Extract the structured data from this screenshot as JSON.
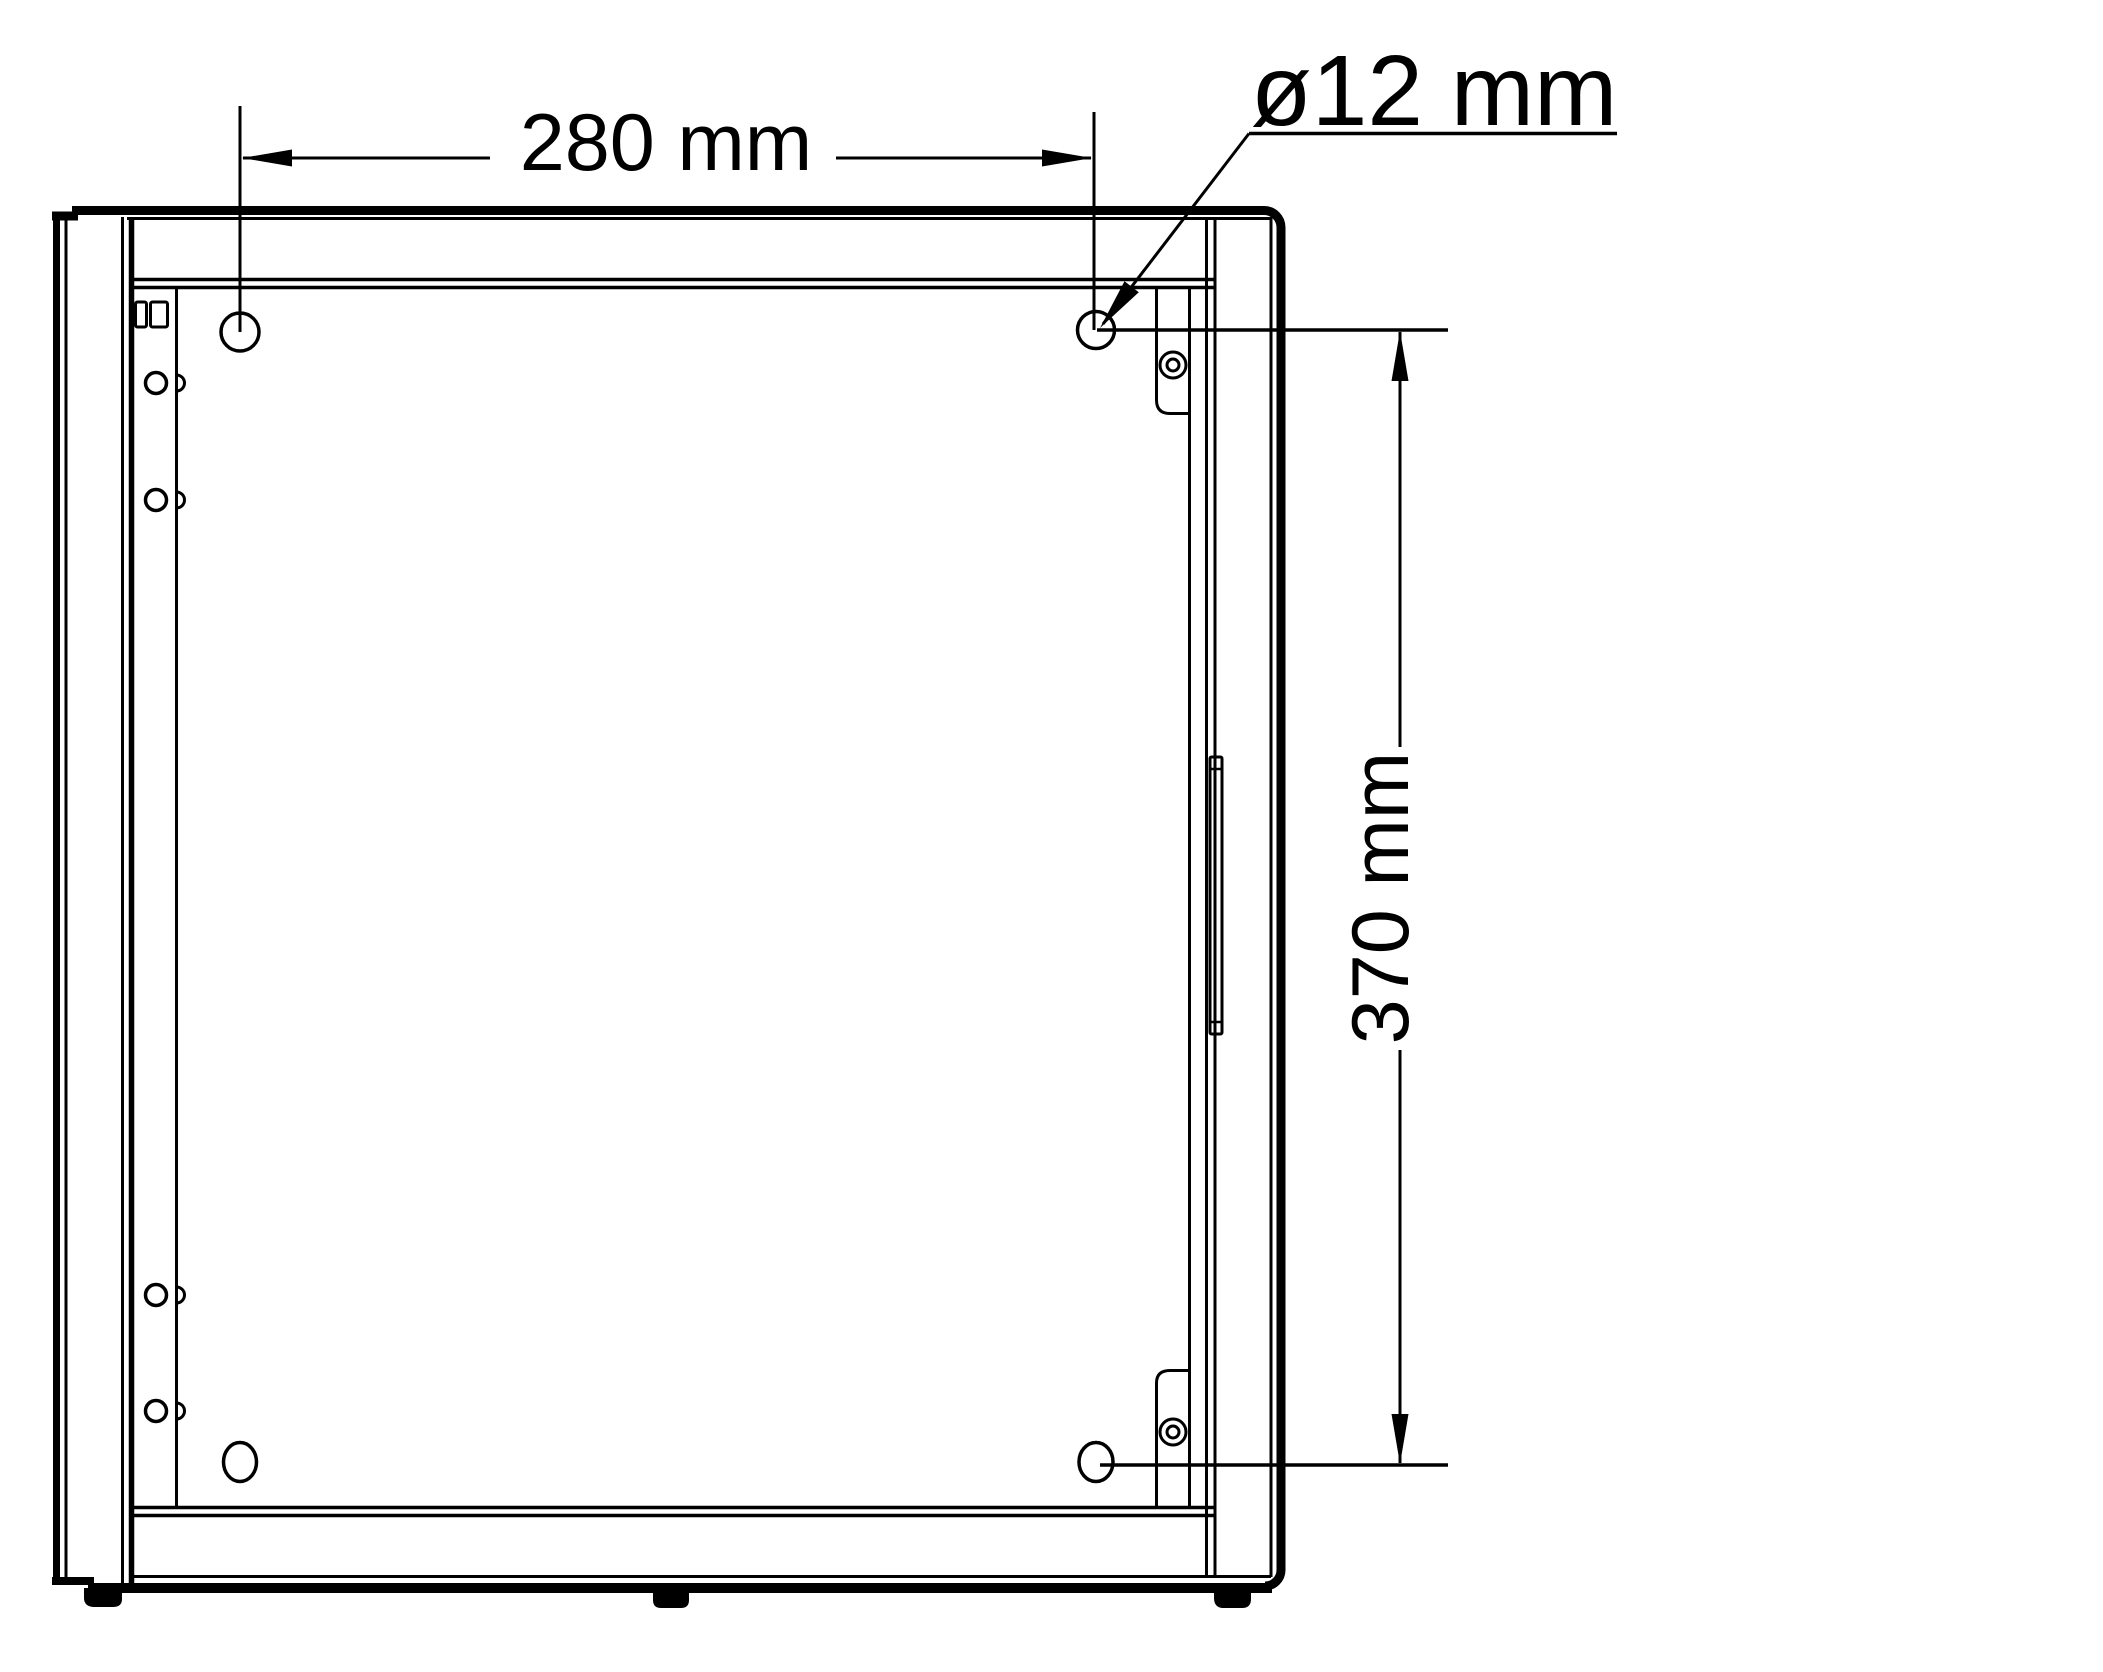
{
  "drawing": {
    "type": "technical-dimension-drawing",
    "view": "rear-panel-with-mounting-holes",
    "colors": {
      "line": "#000000",
      "background": "#ffffff"
    },
    "dimensions": {
      "horizontal_hole_spacing": "280 mm",
      "hole_diameter": "ø12 mm",
      "vertical_hole_spacing": "370 mm"
    },
    "mounting_holes_count": 4
  }
}
